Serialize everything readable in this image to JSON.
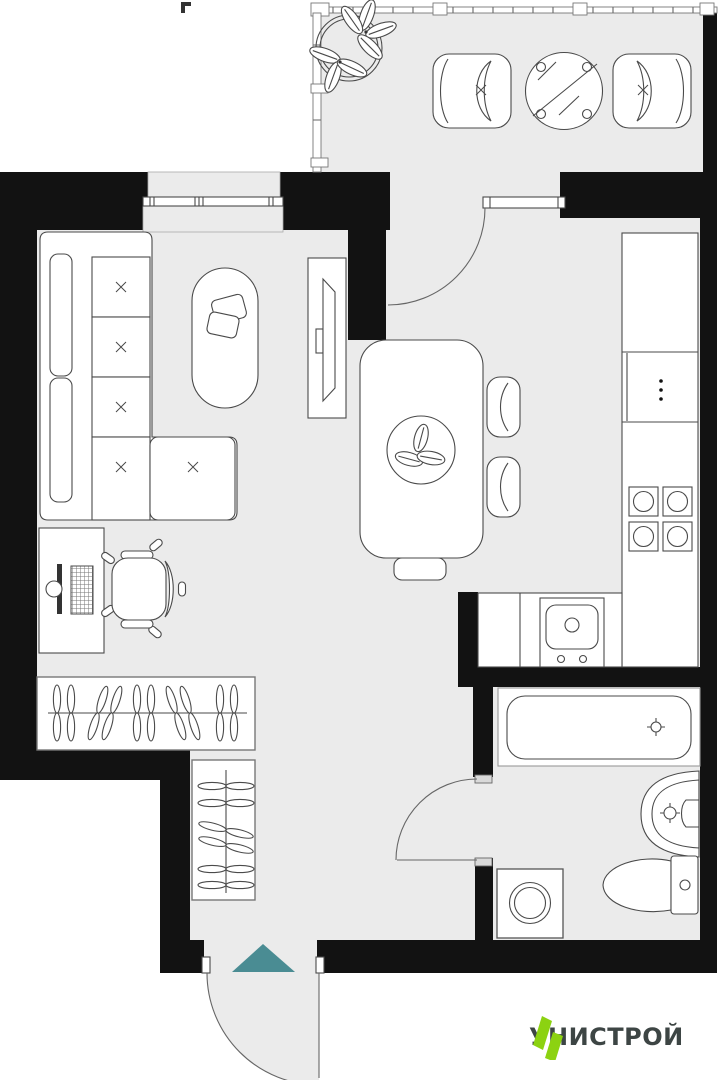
{
  "logo": {
    "text": "УНИСТРОЙ",
    "mark": "double-parallelogram-icon"
  },
  "colors": {
    "wall": "#121212",
    "floor": "#ebebeb",
    "line": "#4a4a4a",
    "line_light": "#9b9b9b",
    "door": "#666666",
    "entry_arrow": "#4a8c93",
    "logo_green": "#8cd211",
    "logo_text": "#3d4544"
  },
  "entry": {
    "symbol": "entry-arrow-up"
  },
  "furniture": {
    "balcony": [
      "potted-plant-icon",
      "armchair-icon",
      "round-glass-table-icon",
      "armchair-icon"
    ],
    "living_room": [
      "corner-sofa-icon",
      "coffee-table-with-books-icon",
      "tv-stand-icon",
      "window"
    ],
    "kitchen": [
      "dining-table-with-decor-icon",
      "chair-icon",
      "chair-icon",
      "stool-icon",
      "kitchen-counter-icon",
      "cooktop-4-burner-icon",
      "kitchen-sink-icon",
      "balcony-door"
    ],
    "hall": [
      "desk-icon",
      "monitor-icon",
      "keyboard-icon",
      "office-chair-icon",
      "wardrobe-hangers-icon",
      "wardrobe-hangers-icon",
      "entry-door"
    ],
    "bathroom": [
      "bathtub-icon",
      "washbasin-icon",
      "toilet-icon",
      "washing-machine-icon",
      "bathroom-door"
    ]
  }
}
